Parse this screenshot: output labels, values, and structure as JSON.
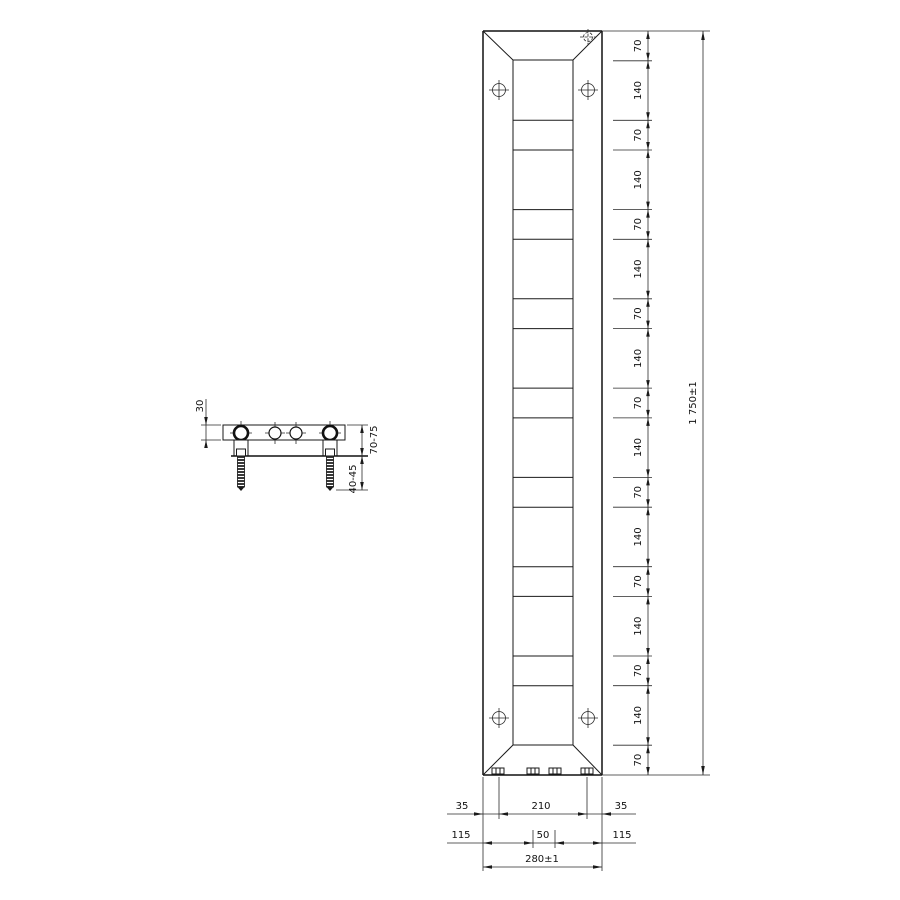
{
  "background_color": "#ffffff",
  "line_color": "#1a1a1a",
  "views": {
    "side_view": {
      "description": "top view of radiator with wall brackets and anchor bolts",
      "depth_label": "30",
      "wall_clearance_label": "70-75",
      "anchor_length_label": "40-45"
    },
    "front_view": {
      "description": "front elevation of tall flat vertical radiator with beveled ends",
      "icons": {
        "mounting_point": "crosshair-circle-icon",
        "air_vent": "dashed-crosshair-icon",
        "connection_stub": "hatched-stub-icon"
      }
    }
  },
  "dimensions": {
    "right_chain": {
      "orientation": "vertical",
      "segment_labels": [
        "70",
        "140",
        "70",
        "140",
        "70",
        "140",
        "70",
        "140",
        "70",
        "140",
        "70",
        "140",
        "70",
        "140",
        "70",
        "140",
        "70"
      ],
      "segment_values_mm": [
        70,
        140,
        70,
        140,
        70,
        140,
        70,
        140,
        70,
        140,
        70,
        140,
        70,
        140,
        70,
        140,
        70
      ],
      "total_label": "1 750±1",
      "total_value_mm": 1750
    },
    "bottom": {
      "row1_left": "35",
      "row1_center": "210",
      "row1_right": "35",
      "row2_left": "115",
      "row2_center": "50",
      "row2_right": "115",
      "row3_total": "280±1"
    }
  }
}
